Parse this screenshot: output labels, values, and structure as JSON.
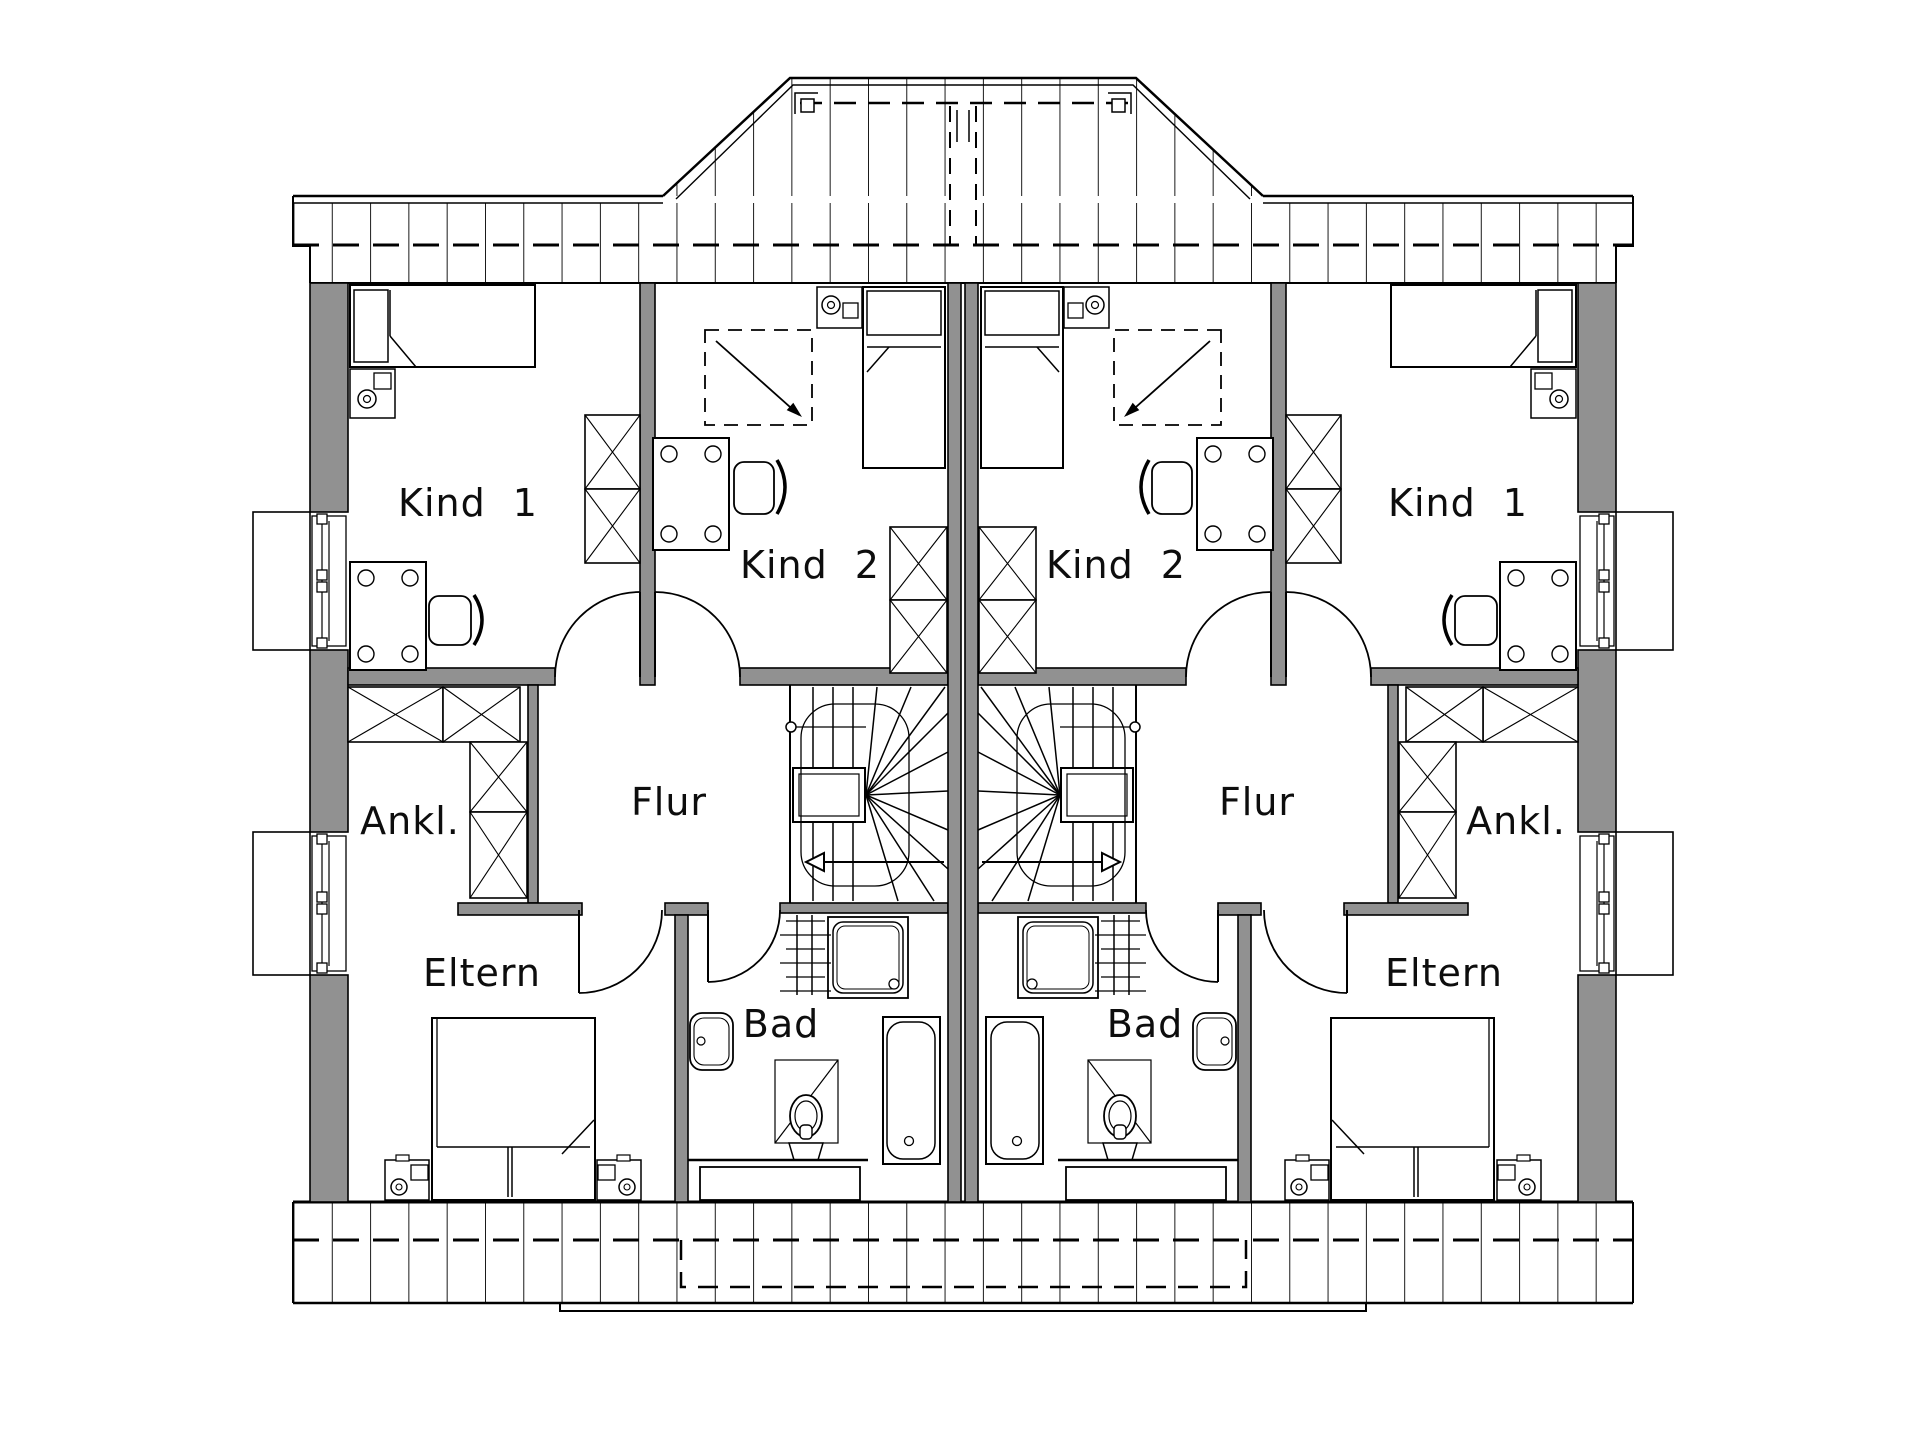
{
  "canvas": {
    "width": 1921,
    "height": 1441,
    "background": "#ffffff"
  },
  "colors": {
    "wall_fill": "#919191",
    "line": "#000000",
    "label_text": "#0d0d0d"
  },
  "plan_type": "floor-plan-upper-storey-duplex",
  "rooms": [
    {
      "id": "kind1-left",
      "label": "Kind 1"
    },
    {
      "id": "kind2-left",
      "label": "Kind 2"
    },
    {
      "id": "flur-left",
      "label": "Flur"
    },
    {
      "id": "ankl-left",
      "label": "Ankl."
    },
    {
      "id": "eltern-left",
      "label": "Eltern"
    },
    {
      "id": "bad-left",
      "label": "Bad"
    },
    {
      "id": "kind1-right",
      "label": "Kind 1"
    },
    {
      "id": "kind2-right",
      "label": "Kind 2"
    },
    {
      "id": "flur-right",
      "label": "Flur"
    },
    {
      "id": "ankl-right",
      "label": "Ankl."
    },
    {
      "id": "eltern-right",
      "label": "Eltern"
    },
    {
      "id": "bad-right",
      "label": "Bad"
    }
  ]
}
